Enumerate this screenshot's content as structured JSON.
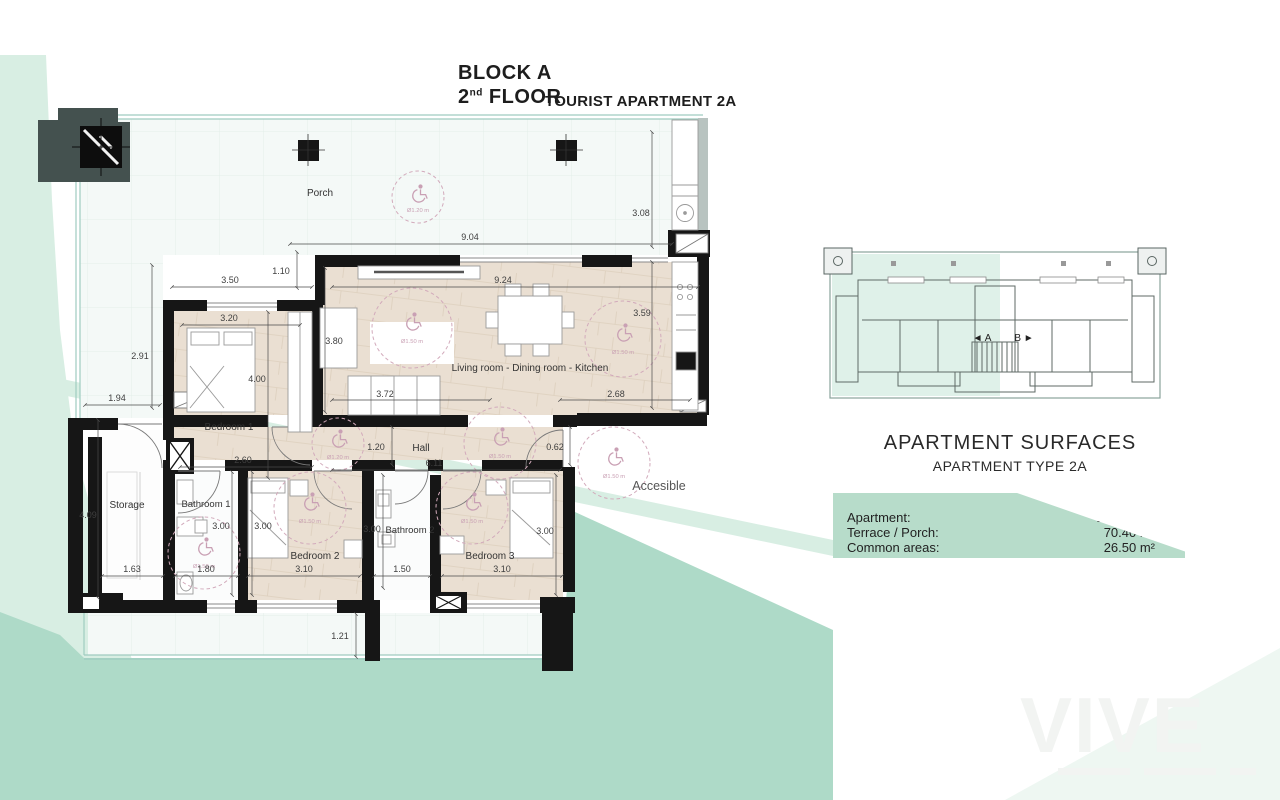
{
  "header": {
    "block": "BLOCK A",
    "floor_number": "2",
    "floor_ordinal": "nd",
    "floor_word": " FLOOR",
    "apartment_title": "TOURIST APARTMENT 2A"
  },
  "plan": {
    "rooms": {
      "porch": "Porch",
      "living": "Living room - Dining room - Kitchen",
      "bedroom1": "Bedroom 1",
      "hall": "Hall",
      "storage": "Storage",
      "bathroom1": "Bathroom 1",
      "bedroom2": "Bedroom 2",
      "bathroom2": "Bathroom 2",
      "bedroom3": "Bedroom 3",
      "accessible": "Accesible"
    },
    "dims": {
      "d308": "3.08",
      "d904": "9.04",
      "d110": "1.10",
      "d350": "3.50",
      "d924": "9.24",
      "d359": "3.59",
      "d320": "3.20",
      "d380": "3.80",
      "d291": "2.91",
      "d400": "4.00",
      "d194": "1.94",
      "d372": "3.72",
      "d268": "2.68",
      "d260": "2.60",
      "d120": "1.20",
      "d611": "6.11",
      "d062": "0.62",
      "d409": "4.09",
      "d300a": "3.00",
      "d300b": "3.00",
      "d300c": "3.00",
      "d300d": "3.00",
      "d163": "1.63",
      "d180": "1.80",
      "d310a": "3.10",
      "d150": "1.50",
      "d310b": "3.10",
      "d121": "1.21"
    },
    "circles": {
      "porch": "Ø1.20 m",
      "living": "Ø1.50 m",
      "kitchen": "Ø1.50 m",
      "hall": "Ø1.50 m",
      "hall_left": "Ø1.20 m",
      "bathroom1": "Ø1.50 m",
      "bedroom2": "Ø1.50 m",
      "bedroom3": "Ø1.50 m",
      "accessible": "Ø1.50 m"
    }
  },
  "overview": {
    "label_a": "◄ A",
    "label_b": "B ►"
  },
  "surfaces": {
    "title": "APARTMENT SURFACES",
    "subtitle": "APARTMENT TYPE 2A",
    "rows": [
      {
        "label": "Apartment:",
        "value": "106.20 m²"
      },
      {
        "label": "Terrace / Porch:",
        "value": "70.40 m²"
      },
      {
        "label": "Common areas:",
        "value": "26.50 m²"
      }
    ]
  },
  "watermark": {
    "text": "VIVE"
  },
  "colors": {
    "teal_band": "#aedac8",
    "mint_light": "#d8eee3",
    "floor_beige": "#eadfd2",
    "wall_black": "#161616",
    "accent_pink": "#cfa6b8",
    "panel_green": "#b7dcca",
    "slate_column": "#44514f"
  }
}
